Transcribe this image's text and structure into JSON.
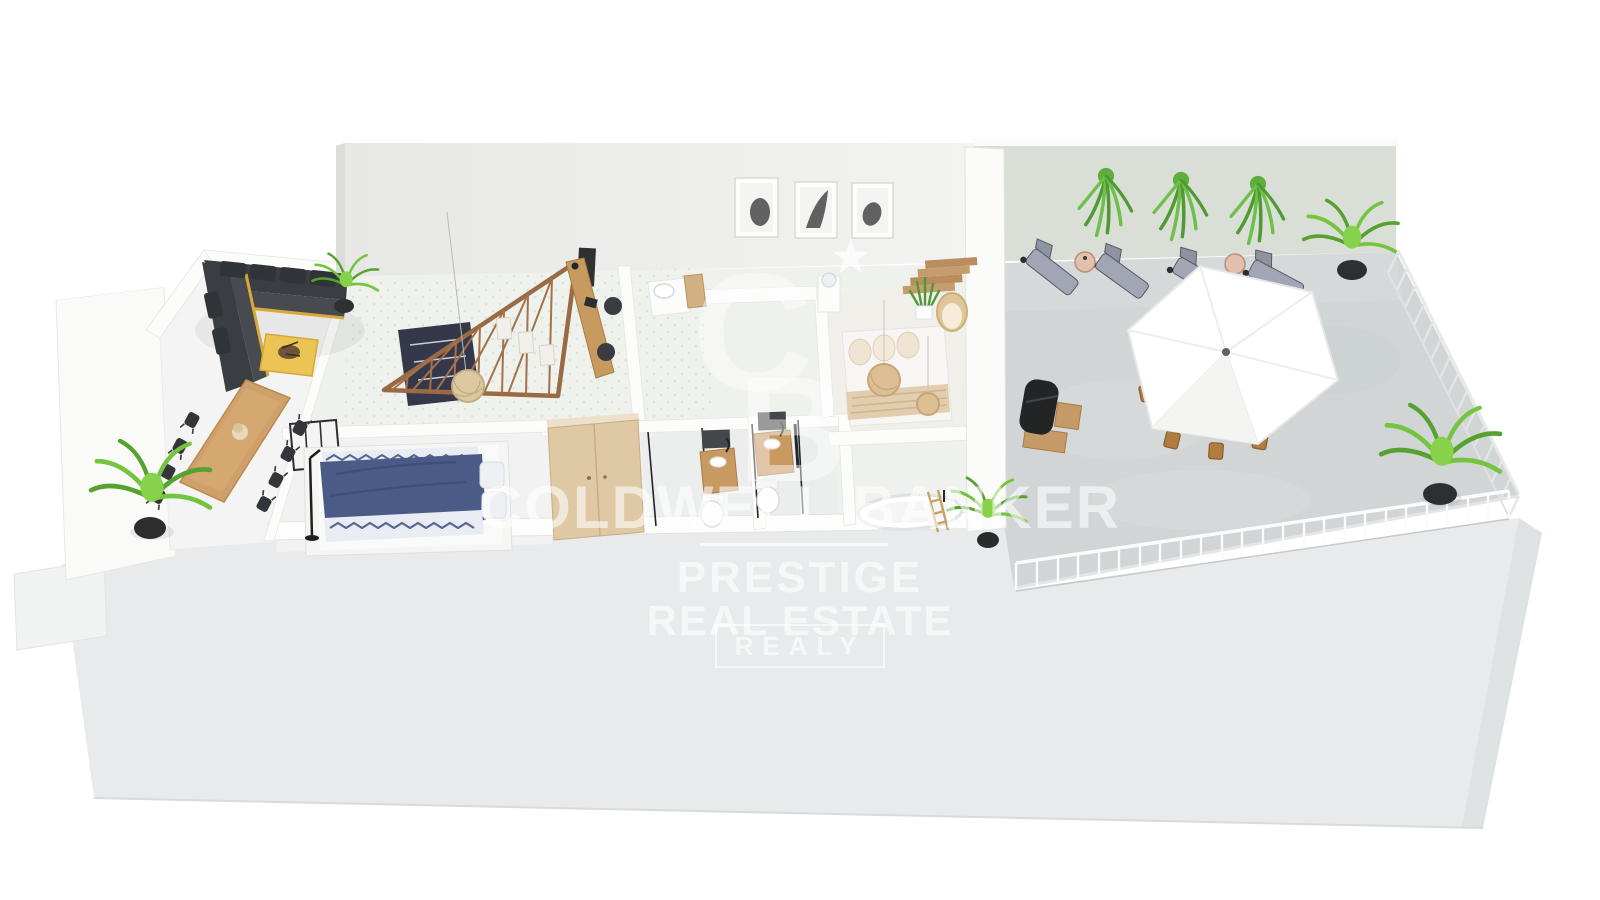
{
  "image": {
    "type": "3d-floor-plan-rendering",
    "background_color": "#ffffff"
  },
  "watermark": {
    "brand_line": "COLDWELL BANKER",
    "logo": {
      "top": "C",
      "bottom": "B",
      "star": "★"
    },
    "line1": "PRESTIGE",
    "line2": "REAL ESTATE",
    "line3_boxed": "REALY",
    "text_color": "rgba(255,255,255,0.6)"
  },
  "palette": {
    "base_platform": "#e8eaeb",
    "interior_walls": "#fbfbfa",
    "back_wall_left": "#efefed",
    "back_wall_right": "#d9ded7",
    "interior_tile_floor": "#edf1ec",
    "right_terrace_floor": "#d1d5d6",
    "left_terrace_floor": "#f3f4f3",
    "wood": "#c79a5f",
    "sofa_charcoal": "#3a3d41",
    "accent_yellow": "#ecc453",
    "bed_navy": "#4a5b87",
    "beige_textile": "#e2cdae",
    "plant_green": "#6fc04a",
    "lounger_gray": "#a2a6b4",
    "parasol_white": "#ffffff"
  },
  "scene_objects": {
    "left_terrace": [
      "corner-sectional-sofa",
      "yellow-coffee-table",
      "decor-bowl",
      "outdoor-dining-table",
      "black-wire-chairs-x8",
      "potted-palm",
      "corner-plant"
    ],
    "interior": [
      "staircase-balustrade",
      "stair-rug",
      "rattan-pendant-lamp",
      "gallery-frames-x3",
      "stair-wall-frames-x3",
      "wall-desk",
      "office-chairs-x2",
      "black-shelf-unit",
      "washbasin-counter",
      "beige-wardrobe",
      "double-bed-navy",
      "floor-lamp",
      "glazed-panel",
      "bathroom-vanities-x2",
      "bathroom-mirrors-x2",
      "toilets-x2",
      "glass-shower-screens",
      "freestanding-bathtub",
      "towel-ladder",
      "potted-plant",
      "master-bed",
      "rattan-pendants-x2",
      "rattan-egg-chair",
      "snake-plant",
      "wood-steps",
      "display-pedestal"
    ],
    "right_terrace": [
      "hanging-plants-x3",
      "sun-loungers-x4",
      "mosaic-side-tables-x2",
      "white-parasol",
      "outdoor-dining-table",
      "wood-chairs-x6",
      "bbq-grill-cart",
      "potted-palms-x2",
      "metal-railing"
    ]
  }
}
